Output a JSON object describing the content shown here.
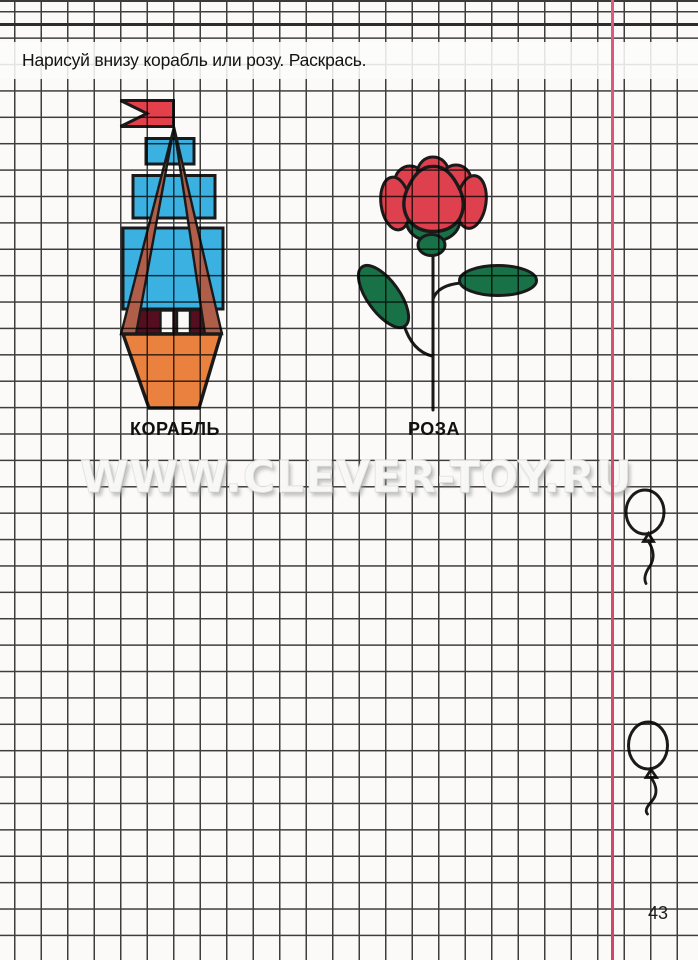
{
  "page": {
    "instruction": "Нарисуй внизу корабль или розу. Раскрась.",
    "watermark": "WWW.CLEVER-TOY.RU",
    "page_number": "43"
  },
  "figures": {
    "ship_label": "КОРАБЛЬ",
    "rose_label": "РОЗА",
    "balloon_count": 2
  },
  "colors": {
    "paper": "#fbfaf8",
    "grid_line": "#3e3e3e",
    "top_rule": "#2d2d2d",
    "margin_line": "#d8506f",
    "outline": "#1a1a1a",
    "flag_red": "#e8414e",
    "sail_blue": "#3cb5e8",
    "hull_orange": "#ee8440",
    "cabin_maroon": "#550e20",
    "window_white": "#ffffff",
    "rigging_brown": "#b2604c",
    "rose_red": "#e2414f",
    "leaf_green": "#187349"
  }
}
